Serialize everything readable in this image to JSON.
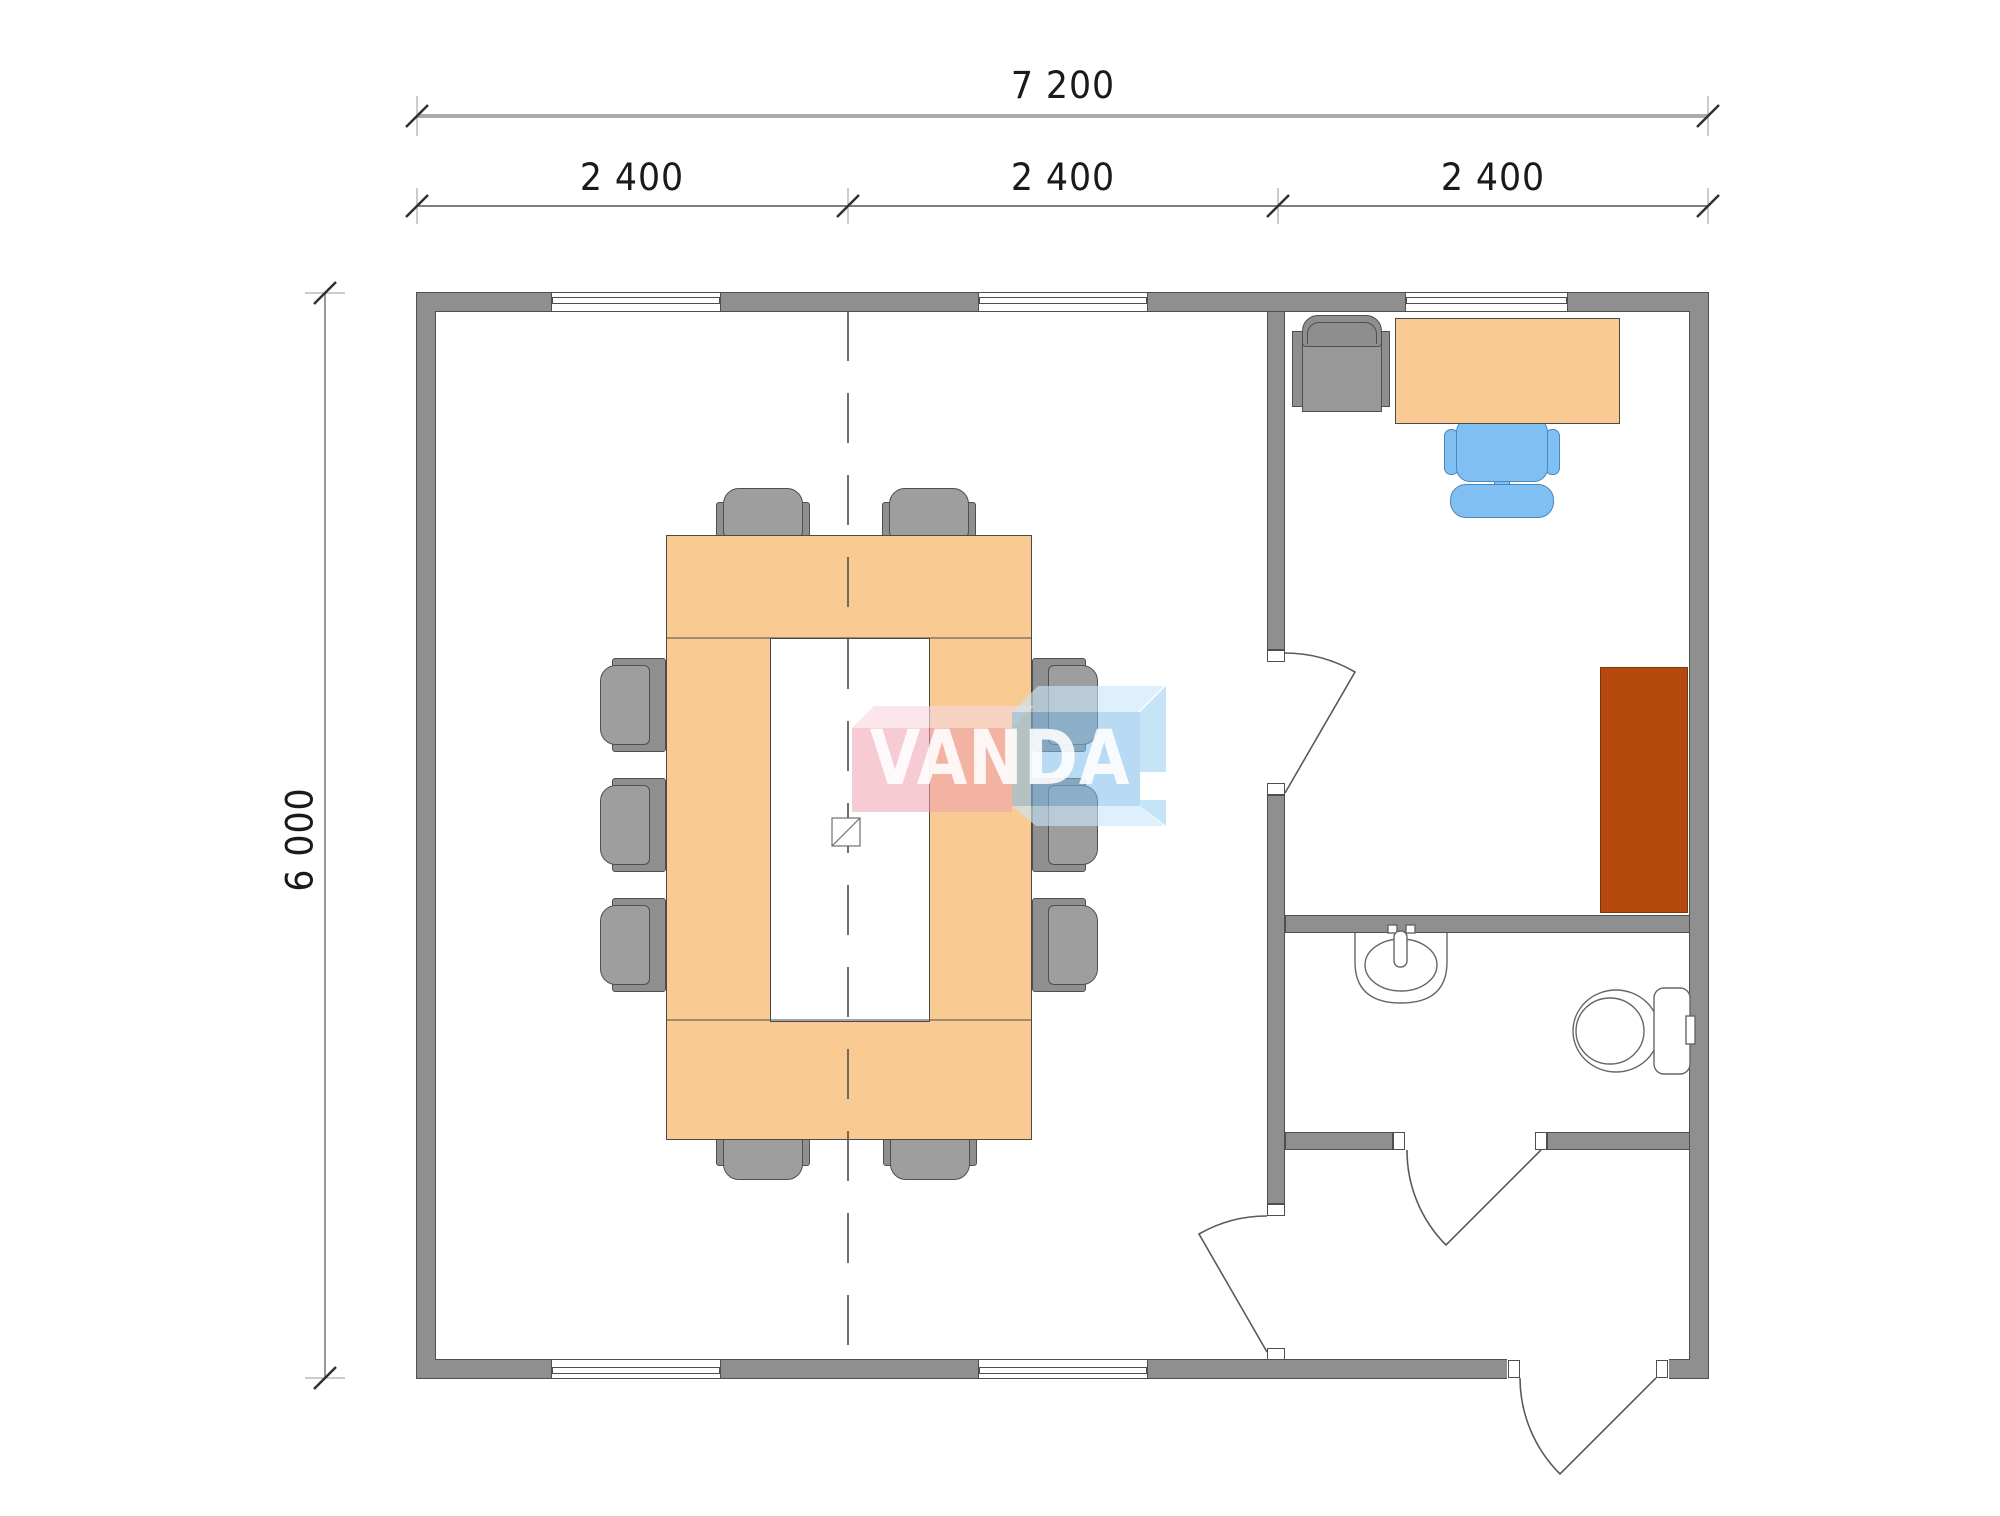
{
  "dimensions": {
    "total_width_label": "7 200",
    "module_labels": [
      "2 400",
      "2 400",
      "2 400"
    ],
    "height_label": "6 000"
  },
  "watermark": {
    "text": "VANDA"
  },
  "colors": {
    "wall": "#8F8F8F",
    "wall_edge": "#4E4E4E",
    "furniture_orange": "#F9CA92",
    "furniture_outline": "#4A4A4A",
    "cabinet_brown": "#B5490E",
    "chair_gray": "#9E9E9E",
    "chair_gray_dark": "#8F8F8F",
    "office_chair_blue": "#7FBFF2",
    "office_chair_blue_outline": "#4C86C0",
    "dimension_text": "#1A1A1A",
    "logo_pink": "rgba(238,160,176,0.55)",
    "logo_pink_light": "rgba(247,214,222,0.62)",
    "logo_blue": "rgba(125,188,232,0.55)",
    "logo_blue_light": "rgba(200,230,248,0.62)",
    "logo_blue_side": "rgba(150,205,240,0.55)",
    "logo_text": "rgba(255,255,255,0.88)"
  },
  "plan": {
    "rooms": [
      "meeting-room",
      "office",
      "bathroom",
      "entrance-hall"
    ],
    "furniture": [
      "ring-conference-table",
      "meeting-chair-x10",
      "office-desk",
      "office-task-chair",
      "guest-armchair",
      "tall-cabinet",
      "washbasin",
      "toilet"
    ],
    "openings": {
      "windows_top": 3,
      "windows_bottom": 2,
      "interior_doors": 3,
      "exterior_doors": 1
    }
  }
}
